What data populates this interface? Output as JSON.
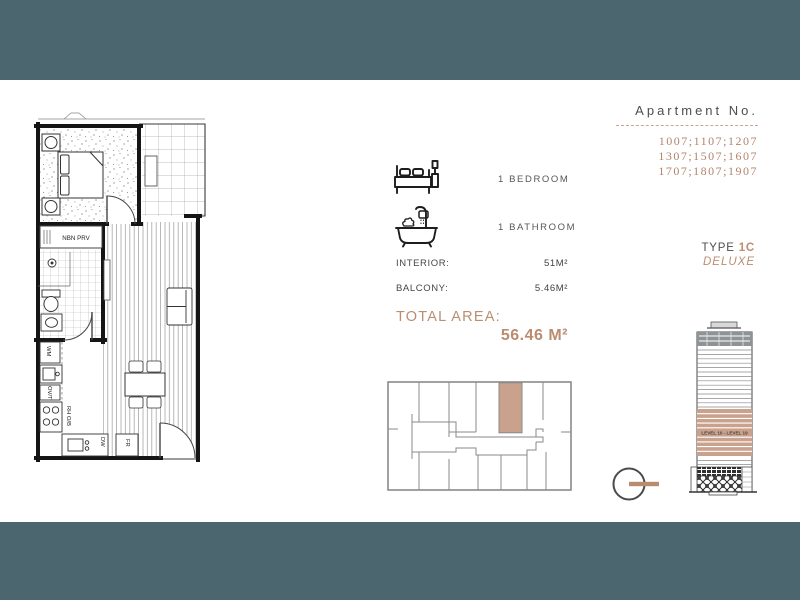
{
  "colors": {
    "teal_band": "#4c6670",
    "tan_text": "#b2846c",
    "tan_highlight": "#c9a18c",
    "gray_text": "#4d4e52",
    "plan_line": "#151515"
  },
  "header": {
    "title": "Apartment No.",
    "numbers": [
      "1007;1107;1207",
      "1307;1507;1607",
      "1707;1807;1907"
    ]
  },
  "unit_type": {
    "label": "TYPE",
    "code": "1C",
    "variant": "DELUXE"
  },
  "features": {
    "bedroom_icon": "bed-icon",
    "bedroom_label": "1 BEDROOM",
    "bathroom_icon": "bathtub-icon",
    "bathroom_label": "1 BATHROOM"
  },
  "areas": {
    "interior_label": "INTERIOR:",
    "interior_value": "51M²",
    "balcony_label": "BALCONY:",
    "balcony_value": "5.46M²",
    "total_label": "TOTAL AREA:",
    "total_value": "56.46 M²"
  },
  "floorplan_labels": {
    "nbn": "NBN PRV",
    "wm": "WM",
    "ovt": "OV/T",
    "rhob": "RH O/B",
    "dw": "DW",
    "fr": "FR"
  },
  "elevation": {
    "band_label": "LEVEL 10 - LEVEL 19"
  },
  "icons": {
    "compass": "north-indicator-icon"
  }
}
